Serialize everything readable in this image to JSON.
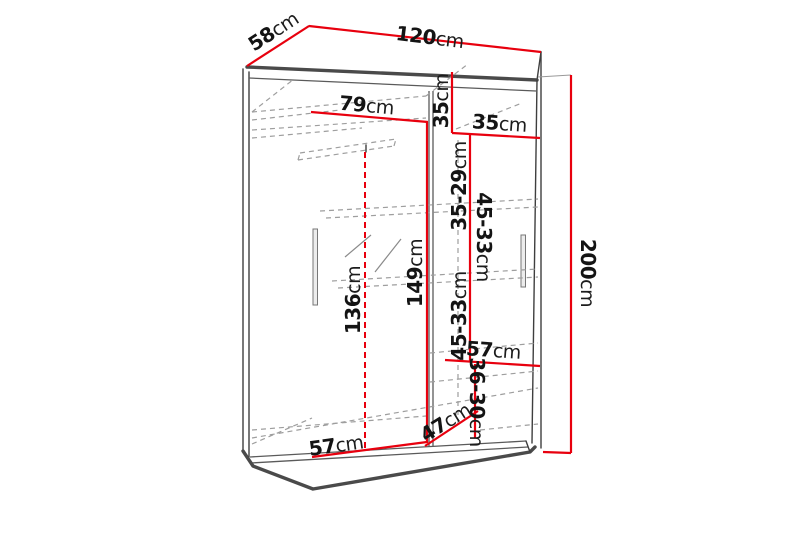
{
  "diagram": {
    "type": "furniture-dimension-drawing",
    "subject": "two-door sliding wardrobe with interior shelving",
    "unit": "cm",
    "colors": {
      "dimension_line": "#e8000e",
      "outline": "#3f3f3f",
      "hidden_line": "#9e9e9e",
      "label_text": "#141414",
      "background": "#ffffff"
    },
    "dimensions": [
      {
        "id": "top-depth",
        "value": "58",
        "unit": "cm"
      },
      {
        "id": "top-width",
        "value": "120",
        "unit": "cm"
      },
      {
        "id": "interior-width-left",
        "value": "79",
        "unit": "cm"
      },
      {
        "id": "top-shelf-height",
        "value": "35",
        "unit": "cm"
      },
      {
        "id": "right-column-width",
        "value": "35",
        "unit": "cm"
      },
      {
        "id": "shelf-gap-upper",
        "value": "35-29",
        "unit": "cm"
      },
      {
        "id": "shelf-gap-middle",
        "value": "45-33",
        "unit": "cm"
      },
      {
        "id": "shelf-gap-lower",
        "value": "45-33",
        "unit": "cm"
      },
      {
        "id": "rail-clearance-height",
        "value": "136",
        "unit": "cm"
      },
      {
        "id": "left-interior-height",
        "value": "149",
        "unit": "cm"
      },
      {
        "id": "total-height",
        "value": "200",
        "unit": "cm"
      },
      {
        "id": "shelf-width-middle",
        "value": "57",
        "unit": "cm"
      },
      {
        "id": "bottom-shelf-gap",
        "value": "36-30",
        "unit": "cm"
      },
      {
        "id": "bottom-depth",
        "value": "47",
        "unit": "cm"
      },
      {
        "id": "bottom-interior-width",
        "value": "57",
        "unit": "cm"
      }
    ]
  }
}
